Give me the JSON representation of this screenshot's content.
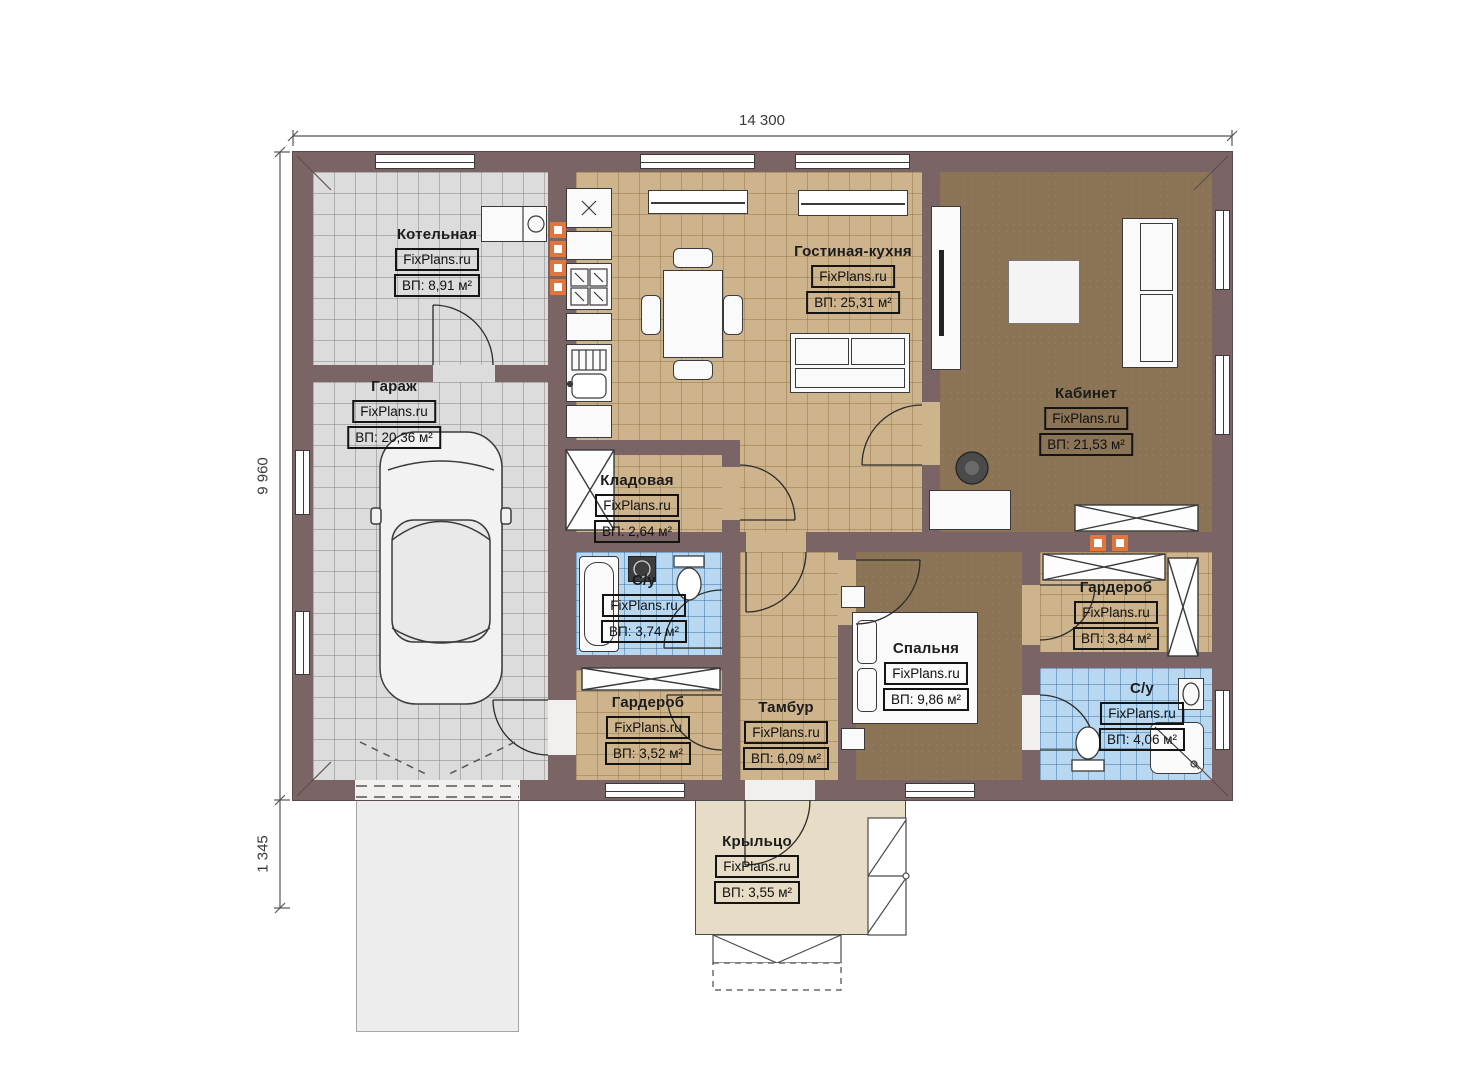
{
  "plan": {
    "title_watermark": "FixPlans.ru",
    "dimensions": {
      "width_top": "14 300",
      "height_left": "9 960",
      "porch_offset_left": "1 345"
    },
    "rooms": [
      {
        "name": "Котельная",
        "watermark": "FixPlans.ru",
        "area": "ВП: 8,91 м²"
      },
      {
        "name": "Гараж",
        "watermark": "FixPlans.ru",
        "area": "ВП: 20,36 м²"
      },
      {
        "name": "Гостиная-кухня",
        "watermark": "FixPlans.ru",
        "area": "ВП: 25,31 м²"
      },
      {
        "name": "Кабинет",
        "watermark": "FixPlans.ru",
        "area": "ВП: 21,53 м²"
      },
      {
        "name": "Кладовая",
        "watermark": "FixPlans.ru",
        "area": "ВП: 2,64 м²"
      },
      {
        "name": "С/у",
        "watermark": "FixPlans.ru",
        "area": "ВП: 3,74 м²"
      },
      {
        "name": "Гардероб",
        "watermark": "FixPlans.ru",
        "area": "ВП: 3,52 м²"
      },
      {
        "name": "Тамбур",
        "watermark": "FixPlans.ru",
        "area": "ВП: 6,09 м²"
      },
      {
        "name": "Спальня",
        "watermark": "FixPlans.ru",
        "area": "ВП: 9,86 м²"
      },
      {
        "name": "Гардероб",
        "watermark": "FixPlans.ru",
        "area": "ВП: 3,84 м²"
      },
      {
        "name": "С/у",
        "watermark": "FixPlans.ru",
        "area": "ВП: 4,06 м²"
      },
      {
        "name": "Крыльцо",
        "watermark": "FixPlans.ru",
        "area": "ВП: 3,55 м²"
      }
    ],
    "colors": {
      "wall": "#7a6466",
      "tile_gray": "#dcdcdc",
      "tile_tan": "#cdb48c",
      "floor_dark": "#8b7355",
      "tile_blue": "#b7d8f0",
      "porch": "#e7ddc6",
      "vent_orange": "#e0763c"
    }
  }
}
